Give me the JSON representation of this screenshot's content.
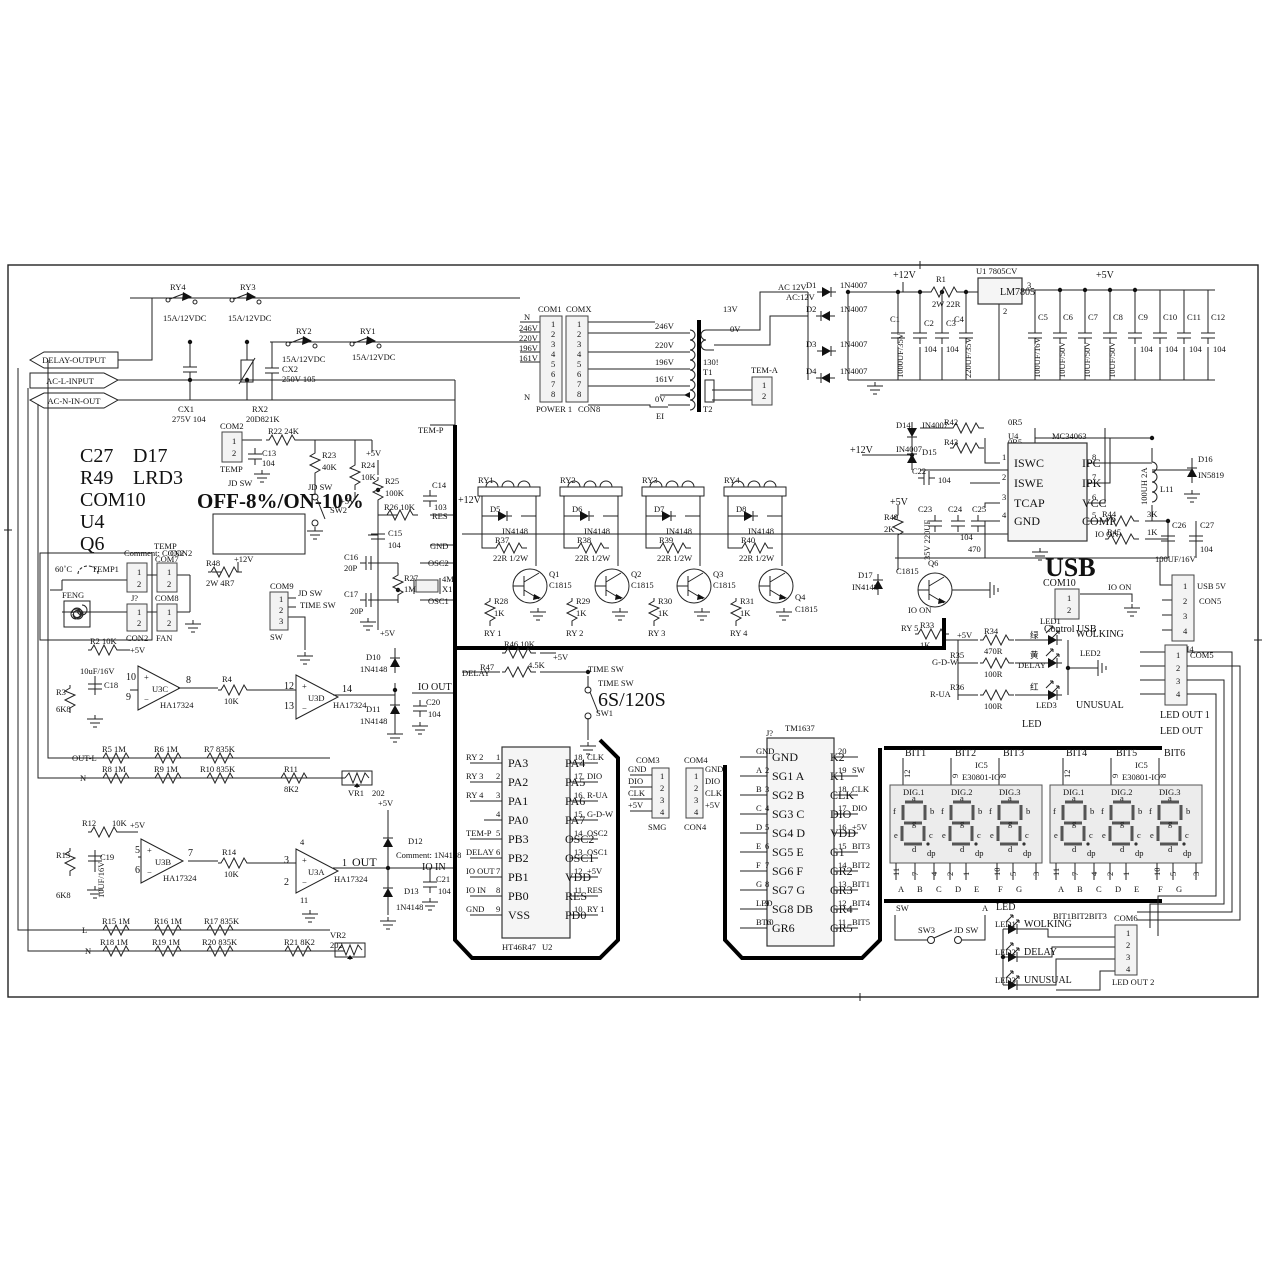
{
  "flags": {
    "delay": "DELAY-OUTPUT",
    "acl": "AC-L-INPUT",
    "acn": "AC-N-IN-OUT"
  },
  "notes": {
    "l1": "C27",
    "l2": "R49",
    "l3": "COM10",
    "l4": "U4",
    "l5": "Q6",
    "r1": "D17",
    "r2": "LRD3",
    "offon": "OFF-8%/ON-10%"
  },
  "topRelays": {
    "ry4": "RY4",
    "ry3": "RY3",
    "ry2": "RY2",
    "ry1": "RY1",
    "rating": "15A/12VDC",
    "cx1": "CX1",
    "cx1v": "275V 104",
    "rx2": "RX2",
    "rx2v": "20D821K",
    "cx2": "CX2",
    "cx2v": "250V 105"
  },
  "pwrcon": {
    "com1": "COM1",
    "comx": "COMX",
    "p": [
      "1",
      "2",
      "3",
      "4",
      "5",
      "6",
      "7",
      "8"
    ],
    "power1": "POWER 1",
    "con8": "CON8",
    "n": "N",
    "v": [
      "246V",
      "220V",
      "196V",
      "161V"
    ],
    "n2": "N"
  },
  "xfmr": {
    "taps": [
      "246V",
      "220V",
      "196V",
      "161V"
    ],
    "zv": "0V",
    "ei": "EI",
    "s13": "13V",
    "s0": "0V",
    "code": "130!",
    "t1": "T1",
    "t2": "T2",
    "tema": "TEM-A",
    "tp": [
      "1",
      "2"
    ]
  },
  "rect": {
    "ac12": "AC 12V",
    "ac12b": "AC:12V",
    "d": [
      [
        "D1",
        "1N4007"
      ],
      [
        "D2",
        "1N4007"
      ],
      [
        "D3",
        "1N4007"
      ],
      [
        "D4",
        "1N4007"
      ]
    ],
    "p12": "+12V",
    "r1": "R1",
    "r1v": "2W 22R",
    "u1": "U1  7805CV",
    "lm": "LM7805",
    "p3": "3",
    "p2": "2",
    "p5": "+5V",
    "c1": "C1",
    "c1v": "1000UF/35V",
    "c2": "C2",
    "c2v": "104",
    "c3": "C3",
    "c3v": "104",
    "c4": "C4",
    "c4v": "220UF/35V",
    "caps": [
      [
        "C5",
        "100UF/16V"
      ],
      [
        "C6",
        "10UF/50V"
      ],
      [
        "C7",
        "10UF/50V"
      ],
      [
        "C8",
        "10UF/50V"
      ],
      [
        "C9",
        "104"
      ],
      [
        "C10",
        "104"
      ],
      [
        "C11",
        "104"
      ],
      [
        "C12",
        "104"
      ]
    ]
  },
  "dcdc": {
    "r42": "R42",
    "r42v": "0R5",
    "r43": "R43",
    "r43v": "0R5",
    "d14": "D14",
    "d14v": "IN4007",
    "d15": "D15",
    "d15v": "IN4007",
    "p12": "+12V",
    "c22": "C22",
    "c22v": "104",
    "u4": "U4",
    "part": "MC34063",
    "lp": [
      [
        "1",
        "ISWC"
      ],
      [
        "2",
        "ISWE"
      ],
      [
        "3",
        "TCAP"
      ],
      [
        "4",
        "GND"
      ]
    ],
    "rp": [
      [
        "8",
        "IPC"
      ],
      [
        "7",
        "IPK"
      ],
      [
        "6",
        "VCC"
      ],
      [
        "5",
        "COMP"
      ]
    ],
    "l11": "L11",
    "l11v": "100UH 2A",
    "d16": "D16",
    "d16v": "IN5819",
    "r44": "R44",
    "r44v": "3K",
    "ioon": "IO ON",
    "r45": "R45",
    "r45v": "1K",
    "c26": "C26",
    "c26v": "100UF/16V",
    "c27": "C27",
    "c27v": "104",
    "c23": "C23",
    "c23v": "35V 220UF",
    "c24": "C24",
    "c24v": "104",
    "c25": "C25",
    "c25v": "470",
    "p5": "+5V",
    "r49": "R49",
    "r49v": "2K"
  },
  "usb": {
    "t": "USB",
    "com10": "COM10",
    "p": [
      "1",
      "2"
    ],
    "ctl": "Control USB",
    "ioon": "IO ON",
    "usb5": "USB 5V",
    "con5": "CON5",
    "com4": "COM4",
    "p4": [
      "1",
      "2",
      "3",
      "4"
    ]
  },
  "q6": {
    "d17": "D17",
    "d17v": "IN4148",
    "q6": "Q6",
    "q6v": "C1815",
    "ioon": "IO ON",
    "ry5": "RY 5",
    "r33": "R33",
    "r33v": "1K"
  },
  "led1": {
    "p5": "+5V",
    "r34": "R34",
    "r34v": "470R",
    "g": "绿",
    "led1": "LED1",
    "wolk": "WOLKING",
    "gdw": "G-D-W",
    "r35": "R35",
    "r35v": "100R",
    "y": "黄",
    "delay": "DELAY",
    "led2": "LED2",
    "rua": "R-UA",
    "r36": "R36",
    "r36v": "100R",
    "r": "红",
    "led3": "LED3",
    "unus": "UNUSUAL",
    "led": "LED",
    "com5": "COM5",
    "p": [
      "1",
      "2",
      "3",
      "4"
    ],
    "out1": "LED OUT 1",
    "out": "LED OUT"
  },
  "tempin": {
    "com2": "COM2",
    "p": [
      "1",
      "2"
    ],
    "temp": "TEMP",
    "jdsw": "JD SW",
    "r22": "R22  24K",
    "c13": "C13",
    "c13v": "104",
    "r23": "R23",
    "r23v": "40K",
    "jdsw2": "JD SW",
    "sw2": "SW2",
    "r24": "R24",
    "r24v": "10K",
    "p5a": "+5V",
    "p5b": "+5V",
    "r25": "R25",
    "r25v": "100K",
    "c14": "C14",
    "c14v": "103",
    "res": "RES",
    "r26": "R26  10K",
    "c15": "C15",
    "c15v": "104",
    "gnd": "GND",
    "c16": "C16",
    "c16v": "20P",
    "osc2": "OSC2",
    "r27": "R27",
    "r27v": "1M",
    "x1": "4M",
    "x1b": "X1",
    "c17": "C17",
    "c17v": "20P",
    "osc1": "OSC1",
    "p5c": "+5V",
    "temp_p": "TEM-P"
  },
  "sens": {
    "t60": "60˚C",
    "temp1": "TEMP1",
    "feng": "FENG",
    "jq": "J?",
    "con2": "CON2",
    "p": [
      "1",
      "2"
    ],
    "cmt": "Comment: CON2",
    "temp": "TEMP",
    "con2b": "CON2",
    "com7": "COM7",
    "com8": "COM8",
    "fan": "FAN",
    "r48": "R48",
    "r48v": "2W 4R7",
    "p12": "+12V",
    "com9": "COM9",
    "p3": [
      "1",
      "2",
      "3"
    ],
    "jdsw": "JD SW",
    "timesw": "TIME SW",
    "sw": "SW"
  },
  "oa1": {
    "r2": "R2  10K",
    "p5": "+5V",
    "c18v": "10uF/16V",
    "c18": "C18",
    "r3": "R3",
    "r3v": "6K8",
    "p10": "10",
    "p9": "9",
    "p8": "8",
    "u3c": "U3C",
    "ha1": "HA17324",
    "r4": "R4",
    "r4v": "10K",
    "p12": "12",
    "p13": "13",
    "p14": "14",
    "u3d": "U3D",
    "ha2": "HA17324",
    "d10": "D10",
    "d10v": "1N4148",
    "ioout": "IO OUT",
    "d11": "D11",
    "d11v": "1N4148",
    "c20": "C20",
    "c20v": "104",
    "outl": "OUT-L",
    "r5": "R5  1M",
    "r6": "R6  1M",
    "r7": "R7  835K",
    "n": "N",
    "r8": "R8  1M",
    "r9": "R9  1M",
    "r10": "R10  835K",
    "r11": "R11",
    "r11v": "8K2",
    "vr1": "VR1",
    "vr1v": "202"
  },
  "oa2": {
    "r12": "R12",
    "r12v": "10K",
    "p5": "+5V",
    "r13": "R13",
    "r13v": "6K8",
    "c19": "C19",
    "c19v": "10UF/16V",
    "p5n": "5",
    "p6": "6",
    "p7": "7",
    "u3b": "U3B",
    "ha1": "HA17324",
    "r14": "R14",
    "r14v": "10K",
    "p3": "3",
    "p2": "2",
    "p1": "1",
    "p4": "4",
    "p11": "11",
    "u3a": "U3A",
    "ha2": "HA17324",
    "out": "OUT",
    "p5v": "+5V",
    "d12": "D12",
    "d12v": "Comment: 1N4148",
    "ioin": "IO IN",
    "d13": "D13",
    "d13v": "1N4148",
    "c21": "C21",
    "c21v": "104",
    "vr2": "VR2",
    "vr2v": "202",
    "r21": "R21  8K2",
    "l": "L",
    "r15": "R15  1M",
    "r16": "R16  1M",
    "r17": "R17  835K",
    "n": "N",
    "r18": "R18  1M",
    "r19": "R19  1M",
    "r20": "R20  835K"
  },
  "drv": {
    "p12": "+12V",
    "ch": [
      {
        "ry": "RY1",
        "d": "D5",
        "dv": "IN4148",
        "r": "R37",
        "rv": "22R 1/2W",
        "q": "Q1",
        "qv": "C1815",
        "rb": "R28",
        "rbv": "1K",
        "net": "RY 1"
      },
      {
        "ry": "RY2",
        "d": "D6",
        "dv": "IN4148",
        "r": "R38",
        "rv": "22R 1/2W",
        "q": "Q2",
        "qv": "C1815",
        "rb": "R29",
        "rbv": "1K",
        "net": "RY 2"
      },
      {
        "ry": "RY3",
        "d": "D7",
        "dv": "IN4148",
        "r": "R39",
        "rv": "22R 1/2W",
        "q": "Q3",
        "qv": "C1815",
        "rb": "R30",
        "rbv": "1K",
        "net": "RY 3"
      },
      {
        "ry": "RY4",
        "d": "D8",
        "dv": "IN4148",
        "r": "R40",
        "rv": "22R 1/2W",
        "q": "Q4",
        "qv": "C1815",
        "rb": "R31",
        "rbv": "1K",
        "net": "RY 4"
      }
    ]
  },
  "dly": {
    "delay": "DELAY",
    "r46": "R46  10K",
    "p5": "+5V",
    "r47": "R47",
    "r47v": "4.5K",
    "tsw": "TIME SW",
    "tsw2": "TIME SW",
    "ss": "6S/120S",
    "sw1": "SW1"
  },
  "mcu": {
    "ref": "HT46R47",
    "u": "U2",
    "rows": [
      {
        "n": "1",
        "l": "PA3",
        "r": "PA4",
        "rn": "18",
        "ls": "RY 2",
        "rs": "CLK"
      },
      {
        "n": "2",
        "l": "PA2",
        "r": "PA5",
        "rn": "17",
        "ls": "RY 3",
        "rs": "DIO"
      },
      {
        "n": "3",
        "l": "PA1",
        "r": "PA6",
        "rn": "16",
        "ls": "RY 4",
        "rs": "R-UA"
      },
      {
        "n": "4",
        "l": "PA0",
        "r": "PA7",
        "rn": "15",
        "ls": "",
        "rs": "G-D-W"
      },
      {
        "n": "5",
        "l": "PB3",
        "r": "OSC2",
        "rn": "14",
        "ls": "TEM-P",
        "rs": "OSC2"
      },
      {
        "n": "6",
        "l": "PB2",
        "r": "OSC1",
        "rn": "13",
        "ls": "DELAY",
        "rs": "OSC1"
      },
      {
        "n": "7",
        "l": "PB1",
        "r": "VDD",
        "rn": "12",
        "ls": "IO OUT",
        "rs": "+5V"
      },
      {
        "n": "8",
        "l": "PB0",
        "r": "RES",
        "rn": "11",
        "ls": "IO IN",
        "rs": "RES"
      },
      {
        "n": "9",
        "l": "VSS",
        "r": "PD0",
        "rn": "10",
        "ls": "GND",
        "rs": "RY 1"
      }
    ]
  },
  "com3": {
    "t": "COM3",
    "sig": [
      "GND",
      "DIO",
      "CLK",
      "+5V"
    ],
    "p": [
      "1",
      "2",
      "3",
      "4"
    ],
    "smg": "SMG"
  },
  "com4b": {
    "t": "COM4",
    "sig": [
      "GND",
      "DIO",
      "CLK",
      "+5V"
    ],
    "p": [
      "1",
      "2",
      "3",
      "4"
    ],
    "con4": "CON4"
  },
  "tm": {
    "t": "TM1637",
    "j": "J?",
    "rows": [
      {
        "ls": "GND",
        "n": "1",
        "l": "GND",
        "r": "K2",
        "rn": "20",
        "rs": ""
      },
      {
        "ls": "A",
        "n": "2",
        "l": "SG1 A",
        "r": "K1",
        "rn": "19",
        "rs": "SW"
      },
      {
        "ls": "B",
        "n": "3",
        "l": "SG2 B",
        "r": "CLK",
        "rn": "18",
        "rs": "CLK"
      },
      {
        "ls": "C",
        "n": "4",
        "l": "SG3 C",
        "r": "DIO",
        "rn": "17",
        "rs": "DIO"
      },
      {
        "ls": "D",
        "n": "5",
        "l": "SG4 D",
        "r": "VDD",
        "rn": "16",
        "rs": "+5V"
      },
      {
        "ls": "E",
        "n": "6",
        "l": "SG5 E",
        "r": "G1",
        "rn": "15",
        "rs": "BIT3"
      },
      {
        "ls": "F",
        "n": "7",
        "l": "SG6 F",
        "r": "GR2",
        "rn": "14",
        "rs": "BIT2"
      },
      {
        "ls": "G",
        "n": "8",
        "l": "SG7 G",
        "r": "GR3",
        "rn": "13",
        "rs": "BIT1"
      },
      {
        "ls": "LED",
        "n": "9",
        "l": "SG8 DB",
        "r": "GR4",
        "rn": "12",
        "rs": "BIT4"
      },
      {
        "ls": "BT6",
        "n": "10",
        "l": "GR6",
        "r": "GR5",
        "rn": "11",
        "rs": "BIT5"
      }
    ]
  },
  "disp": {
    "bits": [
      "BIT1",
      "BIT2",
      "BIT3",
      "BIT4",
      "BIT5",
      "BIT6"
    ],
    "pn": [
      "12",
      "9",
      "8"
    ],
    "ic": "IC5",
    "icp": "E30801-IO",
    "digs": [
      "DIG.1",
      "DIG.2",
      "DIG.3"
    ],
    "seg": {
      "a": "a",
      "b": "b",
      "c": "c",
      "d": "d",
      "e": "e",
      "f": "f",
      "g": "g",
      "dp": "dp"
    },
    "num": [
      "11",
      "7",
      "4",
      "2",
      "1",
      "10",
      "5",
      "3"
    ],
    "abc": [
      "A",
      "B",
      "C",
      "D",
      "E",
      "F",
      "G"
    ]
  },
  "sw3": {
    "sw": "SW",
    "sw3": "SW3",
    "jdsw": "JD SW",
    "a": "A"
  },
  "led2": {
    "led": "LED",
    "led1": "LED1",
    "wolk": "WOLKING",
    "bits": "BIT1BIT2BIT3",
    "led2": "LED2",
    "delay": "DELAY",
    "led3": "LED3",
    "unus": "UNUSUAL",
    "com6": "COM6",
    "p": [
      "1",
      "2",
      "3",
      "4"
    ],
    "out2": "LED OUT 2"
  }
}
